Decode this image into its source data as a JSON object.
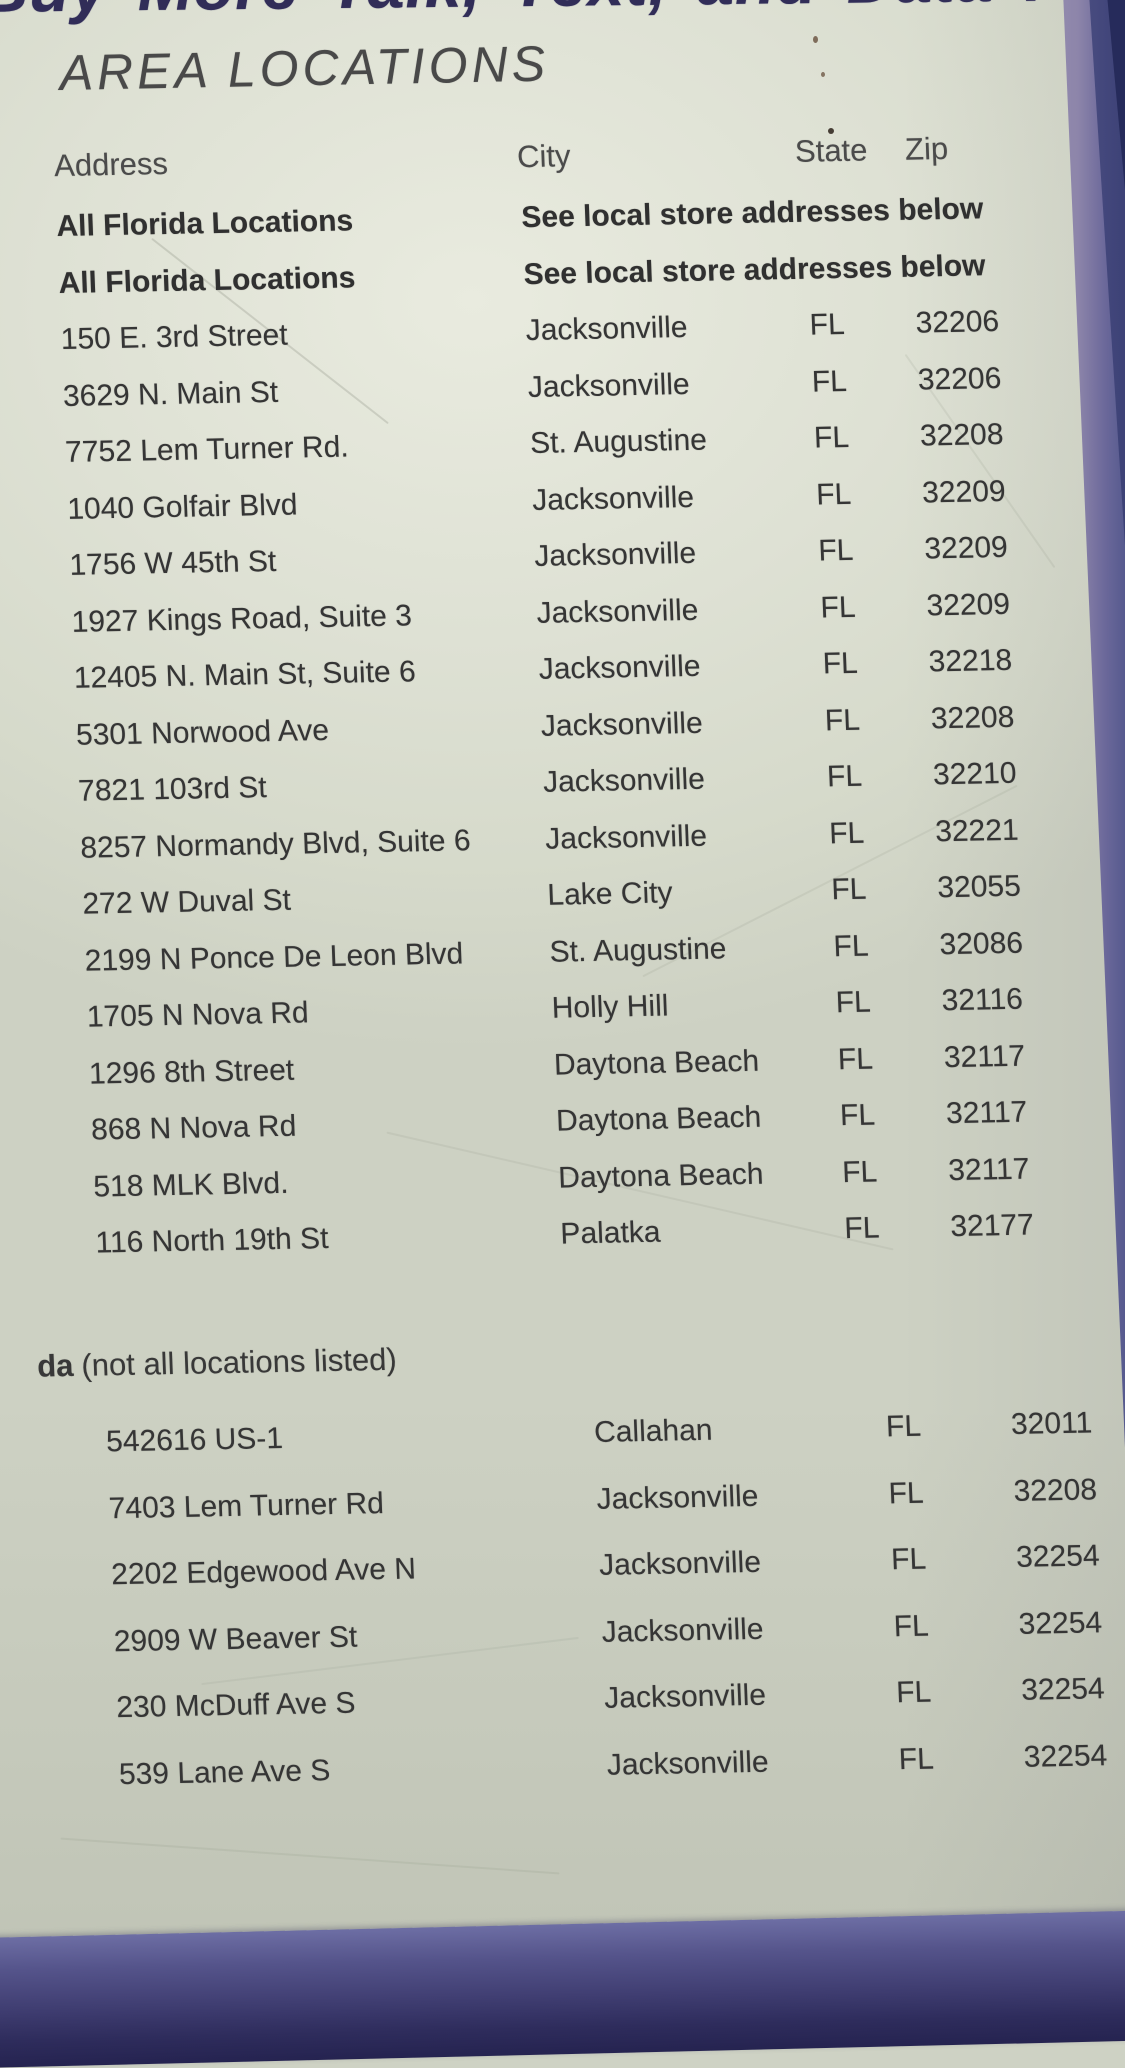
{
  "page": {
    "headline_clipped": "Buy More Talk, Text, and Data !",
    "title": "AREA LOCATIONS",
    "columns": {
      "address": "Address",
      "city": "City",
      "state": "State",
      "zip": "Zip"
    },
    "section1": {
      "rows": [
        {
          "address": "All Florida Locations",
          "note": "See local store addresses below",
          "bold": true
        },
        {
          "address": "All Florida Locations",
          "note": "See local store addresses below",
          "bold": true
        },
        {
          "address": "150 E. 3rd Street",
          "city": "Jacksonville",
          "state": "FL",
          "zip": "32206"
        },
        {
          "address": "3629 N. Main St",
          "city": "Jacksonville",
          "state": "FL",
          "zip": "32206"
        },
        {
          "address": "7752 Lem Turner Rd.",
          "city": "St. Augustine",
          "state": "FL",
          "zip": "32208"
        },
        {
          "address": "1040 Golfair Blvd",
          "city": "Jacksonville",
          "state": "FL",
          "zip": "32209"
        },
        {
          "address": "1756 W 45th St",
          "city": "Jacksonville",
          "state": "FL",
          "zip": "32209"
        },
        {
          "address": "1927 Kings Road, Suite 3",
          "city": "Jacksonville",
          "state": "FL",
          "zip": "32209"
        },
        {
          "address": "12405 N. Main St, Suite 6",
          "city": "Jacksonville",
          "state": "FL",
          "zip": "32218"
        },
        {
          "address": "5301 Norwood Ave",
          "city": "Jacksonville",
          "state": "FL",
          "zip": "32208"
        },
        {
          "address": "7821 103rd St",
          "city": "Jacksonville",
          "state": "FL",
          "zip": "32210"
        },
        {
          "address": "8257 Normandy Blvd, Suite 6",
          "city": "Jacksonville",
          "state": "FL",
          "zip": "32221"
        },
        {
          "address": "272 W Duval St",
          "city": "Lake City",
          "state": "FL",
          "zip": "32055"
        },
        {
          "address": "2199 N Ponce De Leon Blvd",
          "city": "St. Augustine",
          "state": "FL",
          "zip": "32086"
        },
        {
          "address": "1705 N Nova Rd",
          "city": "Holly Hill",
          "state": "FL",
          "zip": "32116"
        },
        {
          "address": "1296 8th Street",
          "city": "Daytona Beach",
          "state": "FL",
          "zip": "32117"
        },
        {
          "address": "868 N Nova Rd",
          "city": "Daytona Beach",
          "state": "FL",
          "zip": "32117"
        },
        {
          "address": "518 MLK Blvd.",
          "city": "Daytona Beach",
          "state": "FL",
          "zip": "32117"
        },
        {
          "address": "116 North 19th St",
          "city": "Palatka",
          "state": "FL",
          "zip": "32177"
        }
      ]
    },
    "section2": {
      "heading_bold": "da",
      "heading_rest": "(not all locations listed)",
      "rows": [
        {
          "address": "542616 US-1",
          "city": "Callahan",
          "state": "FL",
          "zip": "32011"
        },
        {
          "address": "7403 Lem Turner Rd",
          "city": "Jacksonville",
          "state": "FL",
          "zip": "32208"
        },
        {
          "address": "2202 Edgewood Ave N",
          "city": "Jacksonville",
          "state": "FL",
          "zip": "32254"
        },
        {
          "address": "2909 W Beaver St",
          "city": "Jacksonville",
          "state": "FL",
          "zip": "32254"
        },
        {
          "address": "230 McDuff Ave S",
          "city": "Jacksonville",
          "state": "FL",
          "zip": "32254"
        },
        {
          "address": "539 Lane Ave S",
          "city": "Jacksonville",
          "state": "FL",
          "zip": "32254"
        }
      ]
    },
    "colors": {
      "paper": "#dee1d4",
      "ink": "#363636",
      "headline_navy": "#312d58",
      "binder_band": "#403e72",
      "binder_edge": "#8d85aa"
    }
  }
}
